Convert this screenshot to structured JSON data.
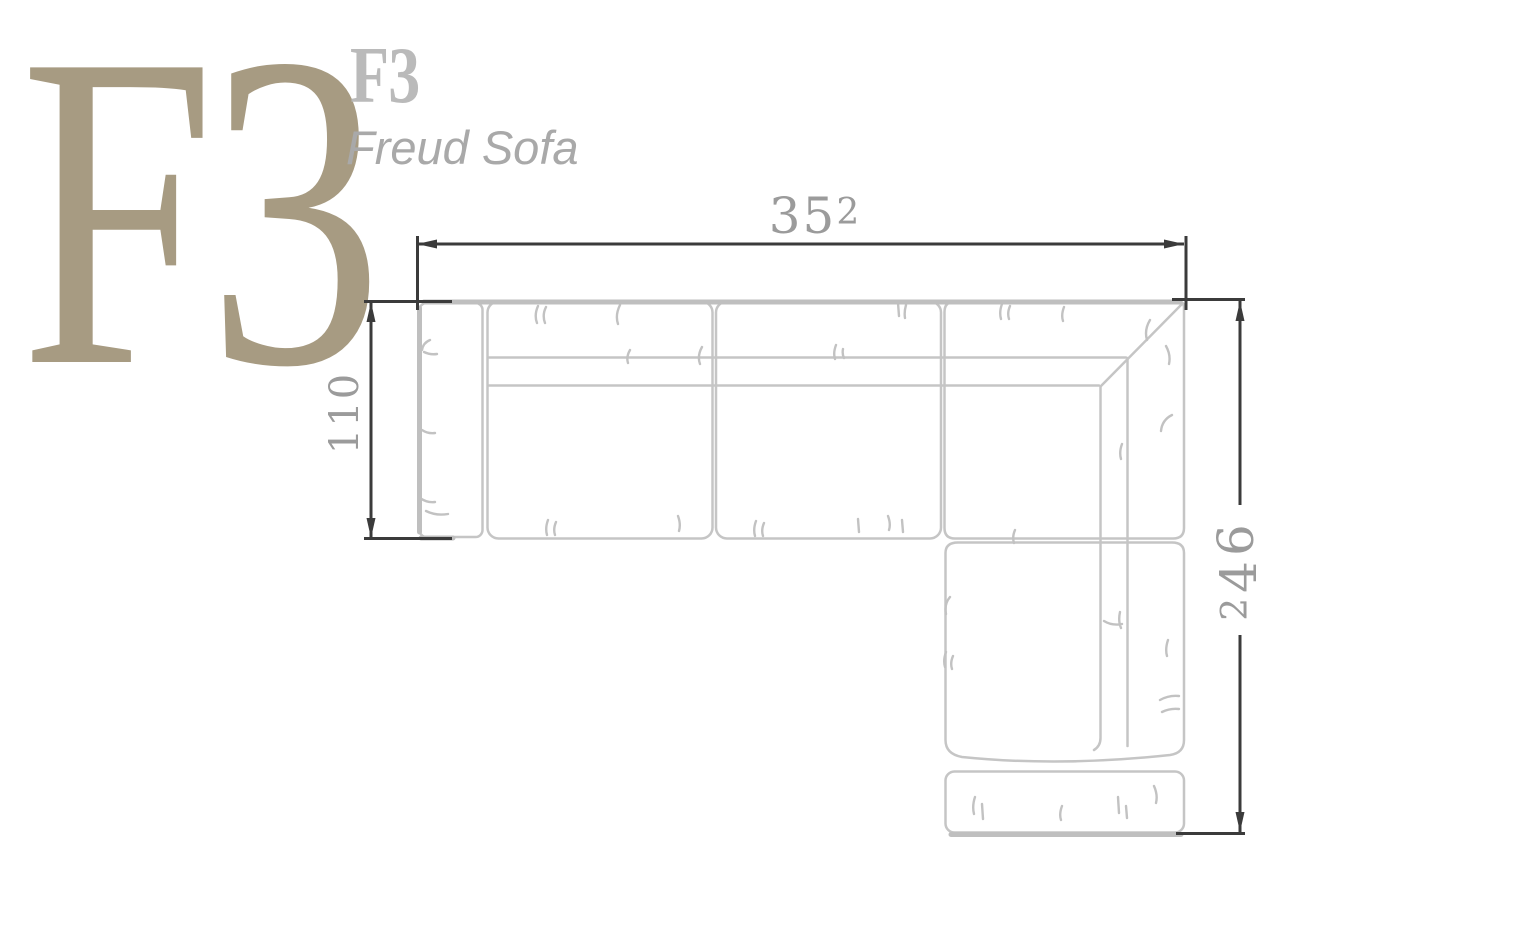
{
  "page": {
    "background": "#ffffff",
    "width": 1516,
    "height": 934
  },
  "branding": {
    "logo_large": "F3",
    "logo_small": "F3",
    "product_name": "Freud Sofa",
    "logo_large_color": "#a79b82",
    "logo_small_color": "#bababa",
    "product_name_color": "#a9a9a9"
  },
  "drawing": {
    "subject": "L-shaped sectional sofa, top view technical plan",
    "sofa_line_color": "#c5c5c5",
    "sofa_accent_color": "#bfbfbf",
    "dimension_line_color": "#3b3b3b",
    "dimension_label_color": "#9b9b9b",
    "dimensions": {
      "width": {
        "value": "352",
        "d1": "3",
        "d2": "5",
        "d3": "2"
      },
      "depth": {
        "value": "110"
      },
      "length": {
        "value": "246",
        "d1": "2",
        "d2": "4",
        "d3": "6"
      }
    }
  }
}
